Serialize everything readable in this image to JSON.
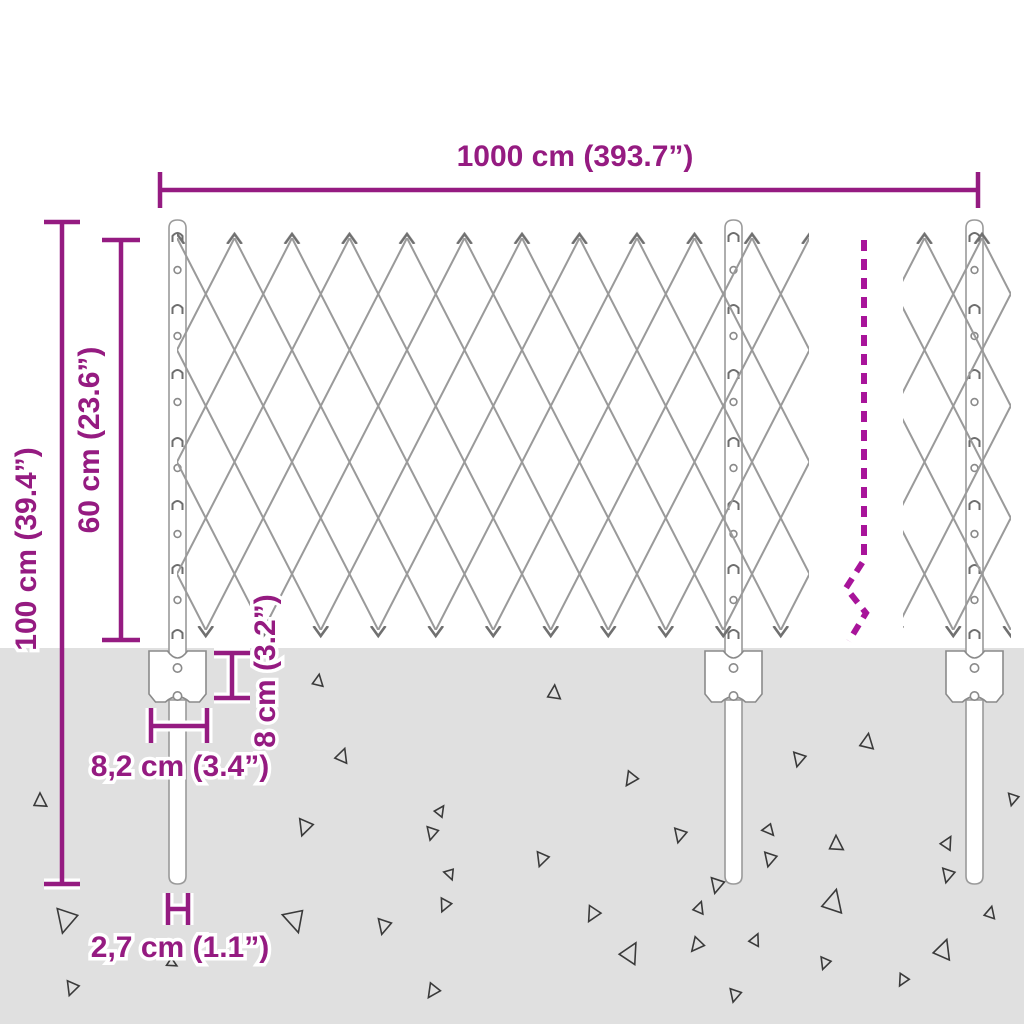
{
  "diagram_title": "chain-link-fence-dimension-diagram",
  "dimensions": {
    "fence_length": "1000 cm (393.7”)",
    "mesh_height": "60 cm (23.6”)",
    "post_total_height": "100 cm (39.4”)",
    "anchor_plate_height": "8 cm (3.2”)",
    "anchor_plate_width": "8,2 cm (3.4”)",
    "post_diameter": "2,7 cm (1.1”)"
  },
  "colors": {
    "dimension_magenta": "#951b81",
    "break_line_magenta": "#a8149a",
    "mesh_gray": "#9a9a9a",
    "ground_gray": "#e0e0e0",
    "debris_outline": "#3a3a3a",
    "background": "#ffffff"
  },
  "posts": {
    "count": 3,
    "centers_x": [
      177.5,
      733.5,
      974.5
    ]
  },
  "ground_triangles": [
    [
      40,
      801,
      13,
      0
    ],
    [
      66,
      920,
      22,
      195
    ],
    [
      72,
      988,
      13,
      200
    ],
    [
      172,
      963,
      9,
      120
    ],
    [
      295,
      920,
      21,
      165
    ],
    [
      305,
      827,
      15,
      200
    ],
    [
      318,
      681,
      11,
      10
    ],
    [
      342,
      756,
      13,
      20
    ],
    [
      384,
      926,
      14,
      195
    ],
    [
      433,
      991,
      13,
      215
    ],
    [
      440,
      811,
      10,
      35
    ],
    [
      450,
      874,
      10,
      160
    ],
    [
      445,
      905,
      12,
      205
    ],
    [
      432,
      833,
      12,
      195
    ],
    [
      542,
      859,
      13,
      200
    ],
    [
      554,
      693,
      13,
      5
    ],
    [
      593,
      914,
      14,
      210
    ],
    [
      631,
      779,
      13,
      215
    ],
    [
      680,
      835,
      13,
      195
    ],
    [
      697,
      945,
      13,
      220
    ],
    [
      717,
      885,
      14,
      195
    ],
    [
      770,
      859,
      13,
      195
    ],
    [
      799,
      759,
      13,
      195
    ],
    [
      836,
      844,
      14,
      0
    ],
    [
      833,
      902,
      21,
      15
    ],
    [
      867,
      742,
      14,
      10
    ],
    [
      948,
      875,
      13,
      195
    ],
    [
      990,
      913,
      11,
      15
    ],
    [
      943,
      950,
      18,
      20
    ],
    [
      903,
      980,
      11,
      210
    ],
    [
      825,
      963,
      11,
      200
    ],
    [
      755,
      940,
      11,
      25
    ],
    [
      735,
      995,
      12,
      195
    ],
    [
      630,
      953,
      19,
      30
    ],
    [
      699,
      908,
      11,
      20
    ],
    [
      769,
      830,
      11,
      140
    ],
    [
      947,
      843,
      12,
      30
    ],
    [
      1013,
      799,
      11,
      195
    ]
  ]
}
